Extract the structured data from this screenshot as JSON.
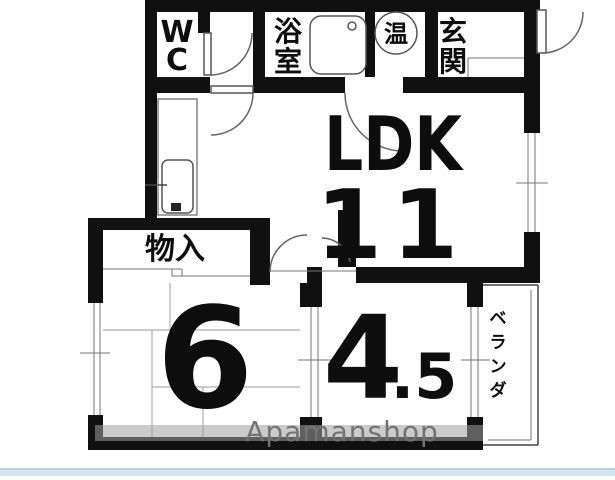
{
  "floorplan": {
    "rooms": {
      "wc": {
        "chars": [
          "W",
          "C"
        ]
      },
      "bath": {
        "chars": [
          "浴",
          "室"
        ]
      },
      "water_heater": {
        "label": "温"
      },
      "entrance": {
        "chars": [
          "玄",
          "関"
        ]
      },
      "ldk": {
        "label": "LDK",
        "size": "11"
      },
      "storage": {
        "label": "物入"
      },
      "room6": {
        "size": "6"
      },
      "room45": {
        "size_main": "4",
        "size_frac": ".5"
      },
      "veranda": {
        "chars": [
          "ベ",
          "ラ",
          "ン",
          "ダ"
        ]
      }
    },
    "watermark": "Apamanshop",
    "colors": {
      "wall": "#101010",
      "line": "#555555",
      "tatami_line": "#b0b0b0",
      "watermark_text": "#737373",
      "watermark_band": "#a0a0a0",
      "bottom_bar": "#d5e5f0",
      "bottom_bar_edge": "#adc6d8",
      "background": "#fefefe"
    }
  }
}
